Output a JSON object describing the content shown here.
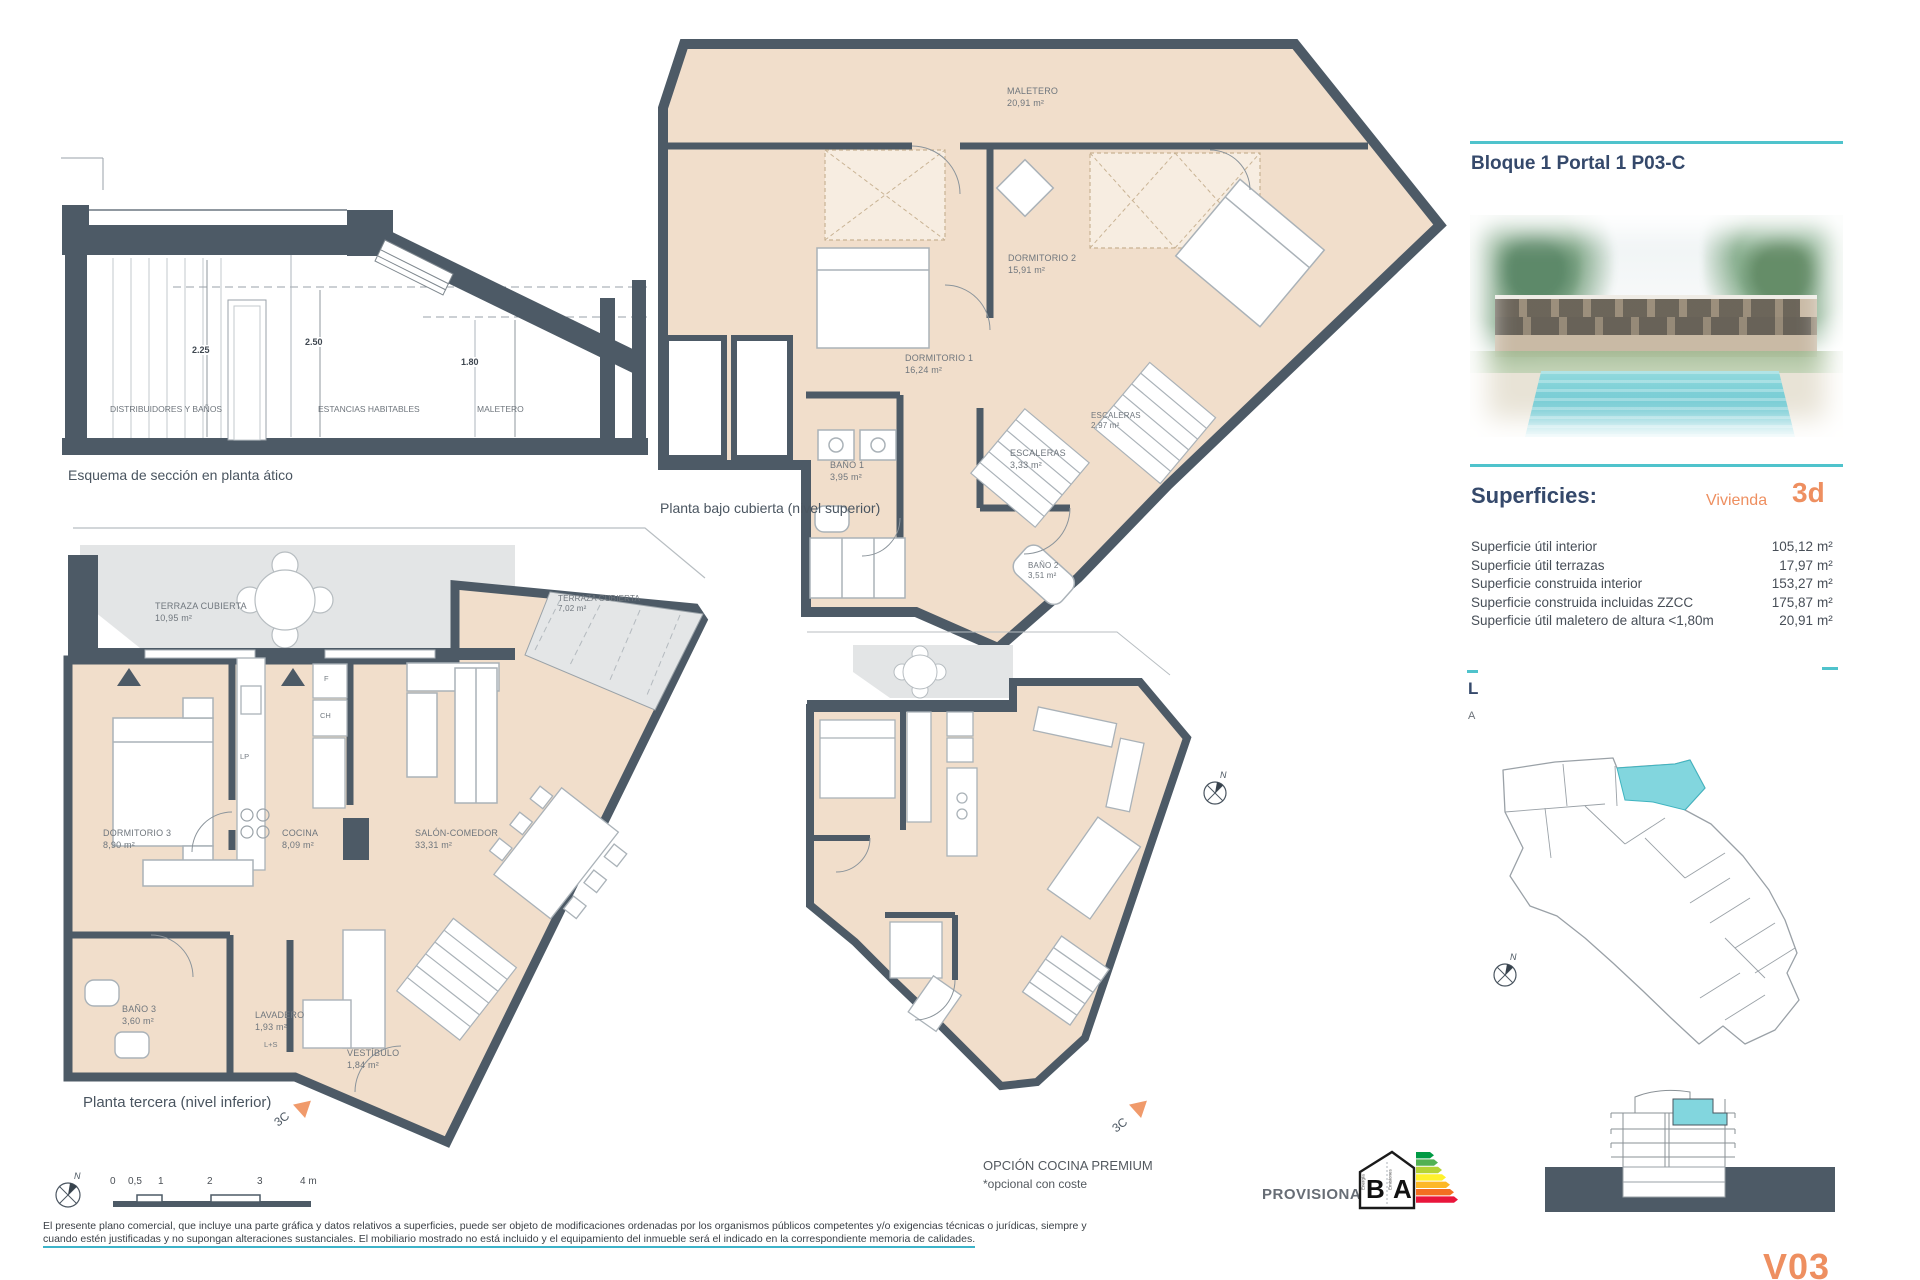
{
  "palette": {
    "wall": "#4d5a66",
    "floor_fill": "#f1decb",
    "terrace_fill": "#e3e5e6",
    "teal_accent": "#4fc3cc",
    "teal_unit": "#82d6de",
    "orange_accent": "#ee8f60",
    "navy_heading": "#35496b"
  },
  "header": {
    "title": "Bloque 1 Portal 1 P03-C"
  },
  "superficies": {
    "heading": "Superficies:",
    "unit_label": "Vivienda",
    "unit_value": "3d",
    "rows": [
      {
        "label": "Superficie útil interior",
        "value": "105,12",
        "unit": "m²"
      },
      {
        "label": "Superficie útil terrazas",
        "value": "17,97",
        "unit": "m²"
      },
      {
        "label": "Superficie construida interior",
        "value": "153,27",
        "unit": "m²"
      },
      {
        "label": "Superficie construida incluidas ZZCC",
        "value": "175,87",
        "unit": "m²"
      },
      {
        "label": "Superficie útil maletero de altura <1,80m",
        "value": "20,91",
        "unit": "m²"
      }
    ],
    "clipped_line1": "L",
    "clipped_line2": "A"
  },
  "section": {
    "caption": "Esquema de sección en planta ático",
    "zones": [
      "DISTRIBUIDORES Y BAÑOS",
      "ESTANCIAS HABITABLES",
      "MALETERO"
    ],
    "dims": [
      "2.25",
      "2.50",
      "1.80"
    ]
  },
  "plan_upper": {
    "caption": "Planta bajo cubierta (nivel superior)",
    "rooms": [
      {
        "name": "MALETERO",
        "area": "20,91 m²"
      },
      {
        "name": "DORMITORIO 2",
        "area": "15,91 m²"
      },
      {
        "name": "DORMITORIO 1",
        "area": "16,24 m²"
      },
      {
        "name": "BAÑO 1",
        "area": "3,95 m²"
      },
      {
        "name": "ESCALERAS",
        "area": "3,33 m²"
      },
      {
        "name": "ESCALERAS",
        "area": "2,97 m²"
      },
      {
        "name": "BAÑO 2",
        "area": "3,51 m²"
      }
    ]
  },
  "plan_lower": {
    "caption": "Planta tercera (nivel inferior)",
    "marker": "3C",
    "rooms": [
      {
        "name": "TERRAZA CUBIERTA",
        "area": "10,95 m²"
      },
      {
        "name": "DORMITORIO 3",
        "area": "8,90 m²"
      },
      {
        "name": "COCINA",
        "area": "8,09 m²"
      },
      {
        "name": "SALÓN-COMEDOR",
        "area": "33,31 m²"
      },
      {
        "name": "TERRAZA CUBIERTA",
        "area": "7,02 m²"
      },
      {
        "name": "BAÑO 3",
        "area": "3,60 m²"
      },
      {
        "name": "LAVADERO",
        "area": "1,93 m²"
      },
      {
        "name": "VESTÍBULO",
        "area": "1,84 m²"
      }
    ],
    "appliance_tags": {
      "f": "F",
      "ch": "CH",
      "lp": "LP",
      "ls": "L+S"
    }
  },
  "plan_option": {
    "title": "OPCIÓN COCINA PREMIUM",
    "subtitle": "*opcional con coste",
    "marker": "3C"
  },
  "scalebar": {
    "ticks": [
      "0",
      "0,5",
      "1",
      "2",
      "3",
      "4 m"
    ],
    "north": "N"
  },
  "energy": {
    "status": "PROVISIONAL",
    "letter_left": "B",
    "letter_right": "A",
    "axis_left": "Energía",
    "axis_right": "Emisiones"
  },
  "sheet": {
    "version": "V03"
  },
  "footer": {
    "line1": "El presente plano comercial, que incluye una parte gráfica y datos relativos a superficies, puede ser objeto de modificaciones ordenadas por los organismos públicos competentes y/o exigencias técnicas o jurídicas, siempre y",
    "line2": "cuando estén justificadas y no supongan alteraciones sustanciales. El mobiliario mostrado no está incluido y el equipamiento del inmueble será el indicado en la correspondiente memoria de calidades."
  }
}
